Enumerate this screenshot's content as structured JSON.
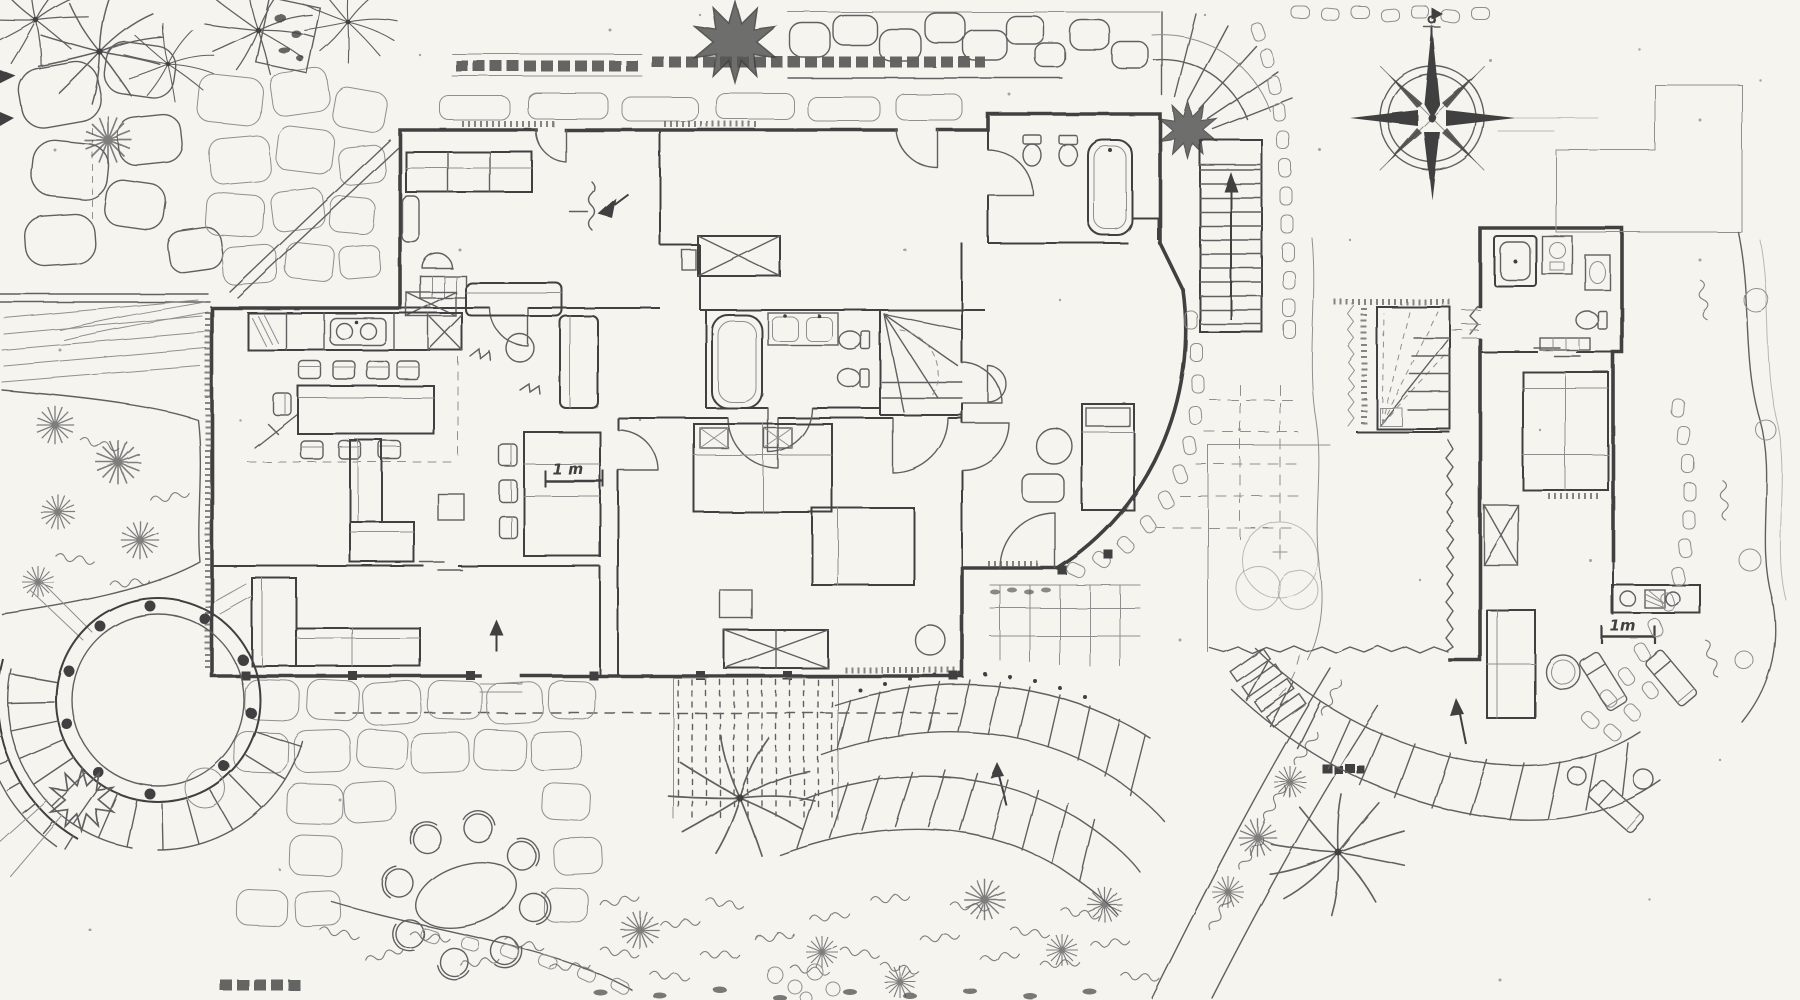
{
  "plan": {
    "scale_bars": [
      {
        "location": "main-house-living-room",
        "label": "1 m"
      },
      {
        "location": "guest-house-terrace",
        "label": "1m"
      }
    ],
    "compass_rose": {
      "icon": "compass-rose-icon",
      "points": 8,
      "orientation": "north-up"
    },
    "colors": {
      "paper": "#f5f4ef",
      "ink_dark": "#414141",
      "ink": "#606060",
      "ink_light": "#8f8f8f"
    }
  }
}
